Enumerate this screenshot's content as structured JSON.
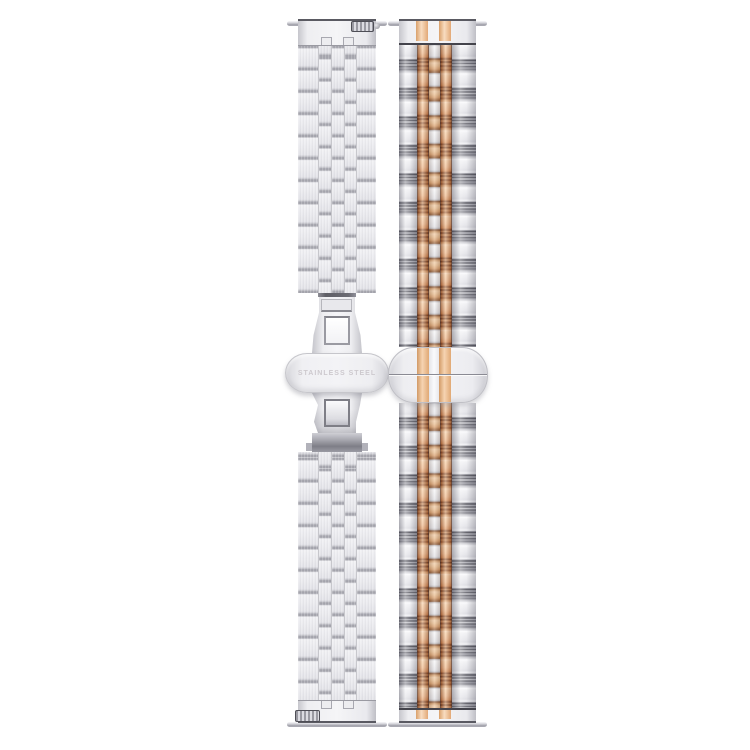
{
  "product_image": {
    "background_color": "#ffffff",
    "subject": "two watch bracelets, front and back views",
    "left_band": {
      "finish": "silver stainless steel",
      "style": "brushed brick-link bracelet with butterfly clasp",
      "clasp_engraving": "STAINLESS STEEL",
      "colors": {
        "link_base": "#eaeaee",
        "link_separator": "#a6a6ae",
        "clasp_plate": "#f0f0f3",
        "clasp_dark_hardware": "#6c6c74",
        "engraving_text": "#cdc9ce"
      }
    },
    "right_band": {
      "finish": "two-tone silver and rose gold",
      "style": "five-link jubilee bracelet with flat fold-over clasp",
      "colors": {
        "silver_bright": "#f0f0f3",
        "silver_groove": "#3f3f48",
        "rose_gold_bright": "#f6cda2",
        "rose_gold_dark": "#6b3315",
        "center_link_white": "#f0f0f3"
      }
    },
    "hardware": {
      "spring_bar_color": "#c6c6cc",
      "quick_release_outline": "#4e4e56"
    }
  }
}
